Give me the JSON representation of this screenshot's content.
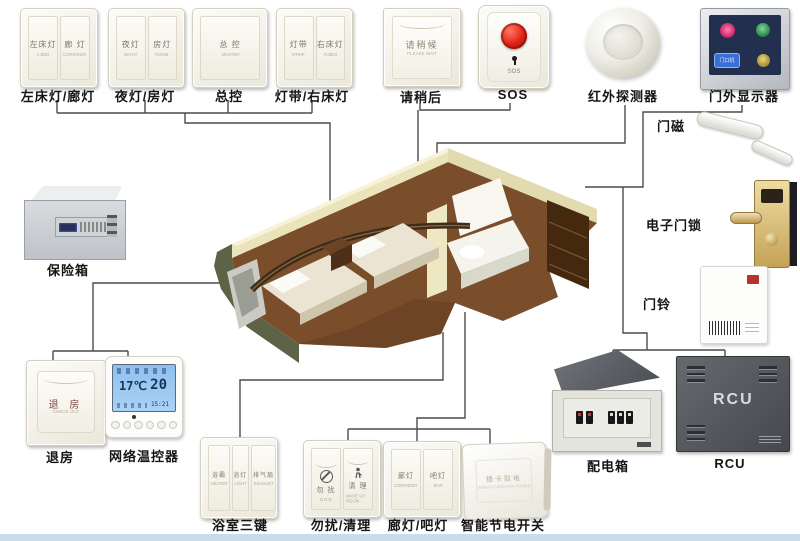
{
  "colors": {
    "line": "#4c4c4c",
    "sos_red": "#d42015",
    "lcd_blue": "#9cc6ef",
    "display_navy": "#232f4e"
  },
  "top_row": {
    "switch_left_bed": {
      "label": "左床灯/廊灯",
      "keys": [
        {
          "text": "左床灯",
          "sub": "L.BED"
        },
        {
          "text": "廊 灯",
          "sub": "CORRIDOR"
        }
      ]
    },
    "switch_night_room": {
      "label": "夜灯/房灯",
      "keys": [
        {
          "text": "夜灯",
          "sub": "NIGHT"
        },
        {
          "text": "房灯",
          "sub": "ROOM"
        }
      ]
    },
    "switch_master": {
      "label": "总控",
      "keys": [
        {
          "text": "总 控",
          "sub": "MASTER"
        }
      ]
    },
    "switch_strip_right_bed": {
      "label": "灯带/右床灯",
      "keys": [
        {
          "text": "灯带",
          "sub": "STRIP"
        },
        {
          "text": "右床灯",
          "sub": "R.BED"
        }
      ]
    },
    "please_wait": {
      "label": "请稍后",
      "text": "请稍候",
      "sub": "PLEASE WAIT"
    },
    "sos": {
      "label": "SOS",
      "text": "SOS"
    },
    "ir_detector": {
      "label": "红外探测器"
    },
    "door_display": {
      "label": "门外显示器",
      "plate_text": "门口机"
    }
  },
  "right_column": {
    "door_magnet": {
      "label": "门磁"
    },
    "door_lock": {
      "label": "电子门锁"
    },
    "doorbell": {
      "label": "门铃"
    }
  },
  "left_column": {
    "safe": {
      "label": "保险箱"
    }
  },
  "bottom_left": {
    "checkout": {
      "label": "退房",
      "text": "退 房",
      "sub": "CHECK OUT"
    },
    "thermostat": {
      "label": "网络温控器",
      "set_temp": "17℃",
      "room_temp": "20",
      "time": "15:21"
    }
  },
  "bottom_row": {
    "bath_keys": {
      "label": "浴室三键",
      "keys": [
        {
          "text": "浴霸",
          "sub": "HEATER"
        },
        {
          "text": "浴灯",
          "sub": "LIGHT"
        },
        {
          "text": "排气扇",
          "sub": "EXHAUST"
        }
      ]
    },
    "dnd_makeup": {
      "label": "勿扰/清理",
      "keys": [
        {
          "text": "勿 扰",
          "sub": "D.N.D"
        },
        {
          "text": "清 理",
          "sub": "MAKE UP ROOM"
        }
      ]
    },
    "corridor_bar": {
      "label": "廊灯/吧灯",
      "keys": [
        {
          "text": "廊灯",
          "sub": "CORRIDOR"
        },
        {
          "text": "吧灯",
          "sub": "BAR"
        }
      ]
    },
    "energy_saver": {
      "label": "智能节电开关",
      "text": "插卡取电",
      "sub": "INSERT CARD FOR POWER"
    }
  },
  "bottom_right": {
    "dist_box": {
      "label": "配电箱"
    },
    "rcu": {
      "label": "RCU",
      "text": "RCU"
    }
  }
}
